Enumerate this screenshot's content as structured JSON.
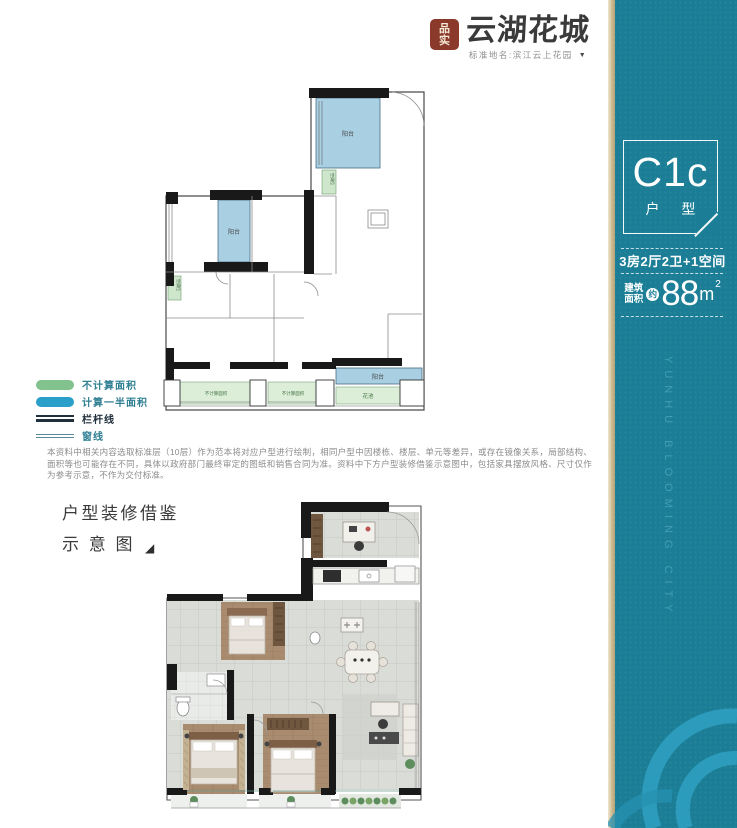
{
  "logo": {
    "seal_line1": "品",
    "seal_line2": "实",
    "brand": "云湖花城",
    "subtitle": "标准地名:滨江云上花园",
    "subtitle_marker": "▼",
    "seal_color": "#8a392b"
  },
  "banner": {
    "unit_code": "C1c",
    "unit_code_label": "户 型",
    "layout_line": "3房2厅2卫+1空间",
    "area_prefix_line1": "建筑",
    "area_prefix_line2": "面积",
    "area_approx": "约",
    "area_value": "88",
    "area_unit": "m",
    "area_sup": "2",
    "vertical_text": "YUNHU BLOOMING CITY",
    "bg_color": "#1b7e96",
    "arc_color": "#2f9fc0",
    "edge_color": "#c9b78d"
  },
  "legend": {
    "items": [
      {
        "label": "不计算面积",
        "symbol": "green-swatch",
        "color": "#82c28e"
      },
      {
        "label": "计算一半面积",
        "symbol": "blue-swatch",
        "color": "#2a9fc9"
      },
      {
        "label": "栏杆线",
        "symbol": "railing-lines",
        "color": "#20303c"
      },
      {
        "label": "窗线",
        "symbol": "window-lines",
        "color": "#5b8a96"
      }
    ]
  },
  "disclaimer": {
    "text": "本资料中相关内容选取标准层（10层）作为范本将对应户型进行绘制，相同户型中因楼栋、楼层、单元等差异，或存在镜像关系，局部结构、面积等也可能存在不同，具体以政府部门最终审定的图纸和销售合同为准。资料中下方户型装修借鉴示意图中，包括家具摆放风格、尺寸仅作为参考示意，不作为交付标准。"
  },
  "section_title": {
    "line1": "户型装修借鉴",
    "line2": "示 意 图",
    "marker": "◢"
  },
  "upper_plan": {
    "labels": {
      "balcony_top": "阳台",
      "balcony_left": "阳台",
      "balcony_bottom": "阳台",
      "flower_bed": "花池",
      "no_area_1": "不计算面积",
      "no_area_2": "不计算面积",
      "ac_1": "空调位",
      "ac_2": "空调位"
    },
    "fills": {
      "half_area_blue": "#a9cfe2",
      "no_area_green": "#dcedd8",
      "wall_black": "#191919"
    }
  },
  "lower_plan": {
    "fills": {
      "tile_gray": "#dadcd8",
      "wood_brown": "#a98c6f",
      "bath_tile": "#e9ebe9",
      "plant_green": "#5d8d5d"
    }
  }
}
